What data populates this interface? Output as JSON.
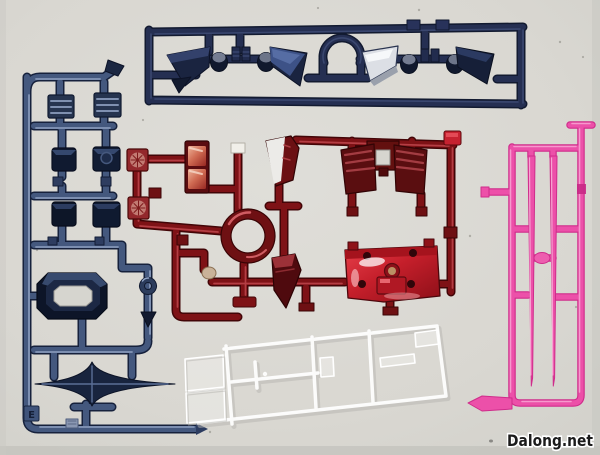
{
  "scene": {
    "type": "photograph",
    "description": "Plastic model kit runner sprues (unassembled parts) laid flat on a light gray surface",
    "background_color": "#dad8d2"
  },
  "watermark": {
    "text": "Dalong.net",
    "color": "#1b1b1b",
    "outline_color": "#ffffff"
  },
  "palette": {
    "background": "#dad8d2",
    "navy_runner": "#252f52",
    "blue_runner": "#44587e",
    "red_runner": "#7e1216",
    "pink_runner": "#ee49a7",
    "clear_runner": "#ffffff",
    "silver_part": "#dcdfe5",
    "bright_red_part": "#c62230",
    "brass_detail": "#bb9064"
  },
  "sprues": {
    "top_navy": {
      "label": "dark navy runner with angular armor fins, round joint cylinders and an arched cutout",
      "color": "#252f52",
      "parts": [
        "armor fin left",
        "joint cylinder",
        "small blocks",
        "armor fin right",
        "arched bridge",
        "silver armor fin",
        "joint cylinder",
        "armor fin dark"
      ]
    },
    "left_blue": {
      "label": "metallic blue runner with ribbed vents, cube blocks, octagonal frame, ring, arrow piece and four-point star antenna",
      "color": "#44587e",
      "corner_tab_letter": "E",
      "parts": [
        "vent grille x2",
        "cube block x4",
        "octagonal frame",
        "small ring",
        "arrow piece",
        "four-point star blade"
      ]
    },
    "center_red": {
      "label": "metallic red runner with thruster squares, shiny twin panel, faced mask piece, chest armor, center ring, side armor and bright skirt plate",
      "color": "#7e1216",
      "parts": [
        "thruster square x2",
        "twin shiny panel",
        "mask piece",
        "chest armor",
        "center ring",
        "side armor wedge",
        "bright skirt plate"
      ]
    },
    "right_pink": {
      "label": "translucent pink runner holding two tapering beam saber blades",
      "color": "#ee49a7",
      "parts": [
        "beam blade x2",
        "oval node"
      ]
    },
    "bottom_clear": {
      "label": "clear transparent runner with faint small parts, lying tilted",
      "color": "#ffffff",
      "parts": [
        "clear box x2",
        "clear slivers"
      ]
    }
  }
}
